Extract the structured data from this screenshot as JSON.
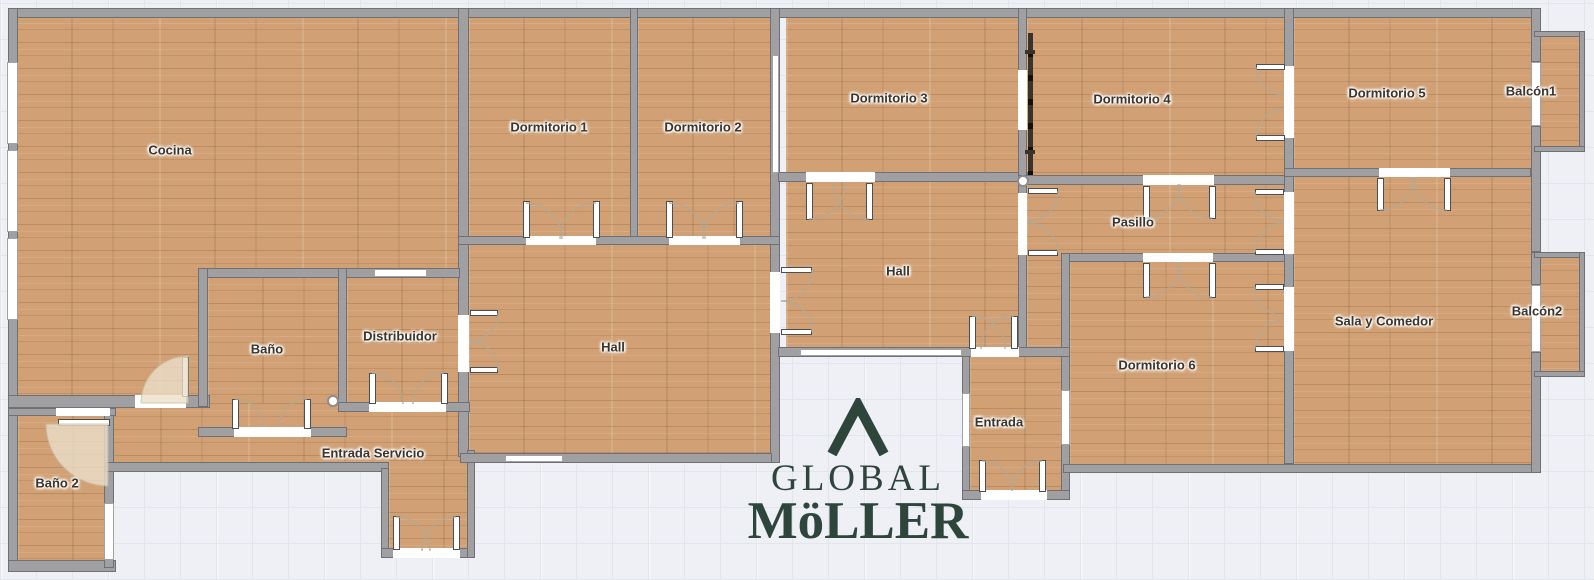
{
  "plan": {
    "rooms": [
      {
        "id": "cocina",
        "label": "Cocina"
      },
      {
        "id": "dormitorio-1",
        "label": "Dormitorio 1"
      },
      {
        "id": "dormitorio-2",
        "label": "Dormitorio 2"
      },
      {
        "id": "dormitorio-3",
        "label": "Dormitorio 3"
      },
      {
        "id": "dormitorio-4",
        "label": "Dormitorio 4"
      },
      {
        "id": "dormitorio-5",
        "label": "Dormitorio 5"
      },
      {
        "id": "balcon-1",
        "label": "Balcón1"
      },
      {
        "id": "hall-superior",
        "label": "Hall"
      },
      {
        "id": "pasillo",
        "label": "Pasillo"
      },
      {
        "id": "sala-y-comedor",
        "label": "Sala y Comedor"
      },
      {
        "id": "balcon-2",
        "label": "Balcón2"
      },
      {
        "id": "dormitorio-6",
        "label": "Dormitorio 6"
      },
      {
        "id": "entrada",
        "label": "Entrada"
      },
      {
        "id": "hall-inferior",
        "label": "Hall"
      },
      {
        "id": "bano",
        "label": "Baño"
      },
      {
        "id": "distribuidor",
        "label": "Distribuidor"
      },
      {
        "id": "entrada-servicio",
        "label": "Entrada Servicio"
      },
      {
        "id": "bano-2",
        "label": "Baño 2"
      }
    ]
  },
  "logo": {
    "mark": "chevron-up",
    "line1": "GLOBAL",
    "line2": "MöLLER"
  },
  "colors": {
    "background": "#eef0f5",
    "grid_line": "#e2e5ec",
    "floor": "#d1a175",
    "wall_fill": "#a09fa2",
    "wall_edge": "#6f7073",
    "door_white": "#ffffff",
    "label_text": "#3a352e",
    "hardware_dark": "#3b332a",
    "swing_fill": "#eadfc9",
    "logo_green": "#2e453c"
  }
}
